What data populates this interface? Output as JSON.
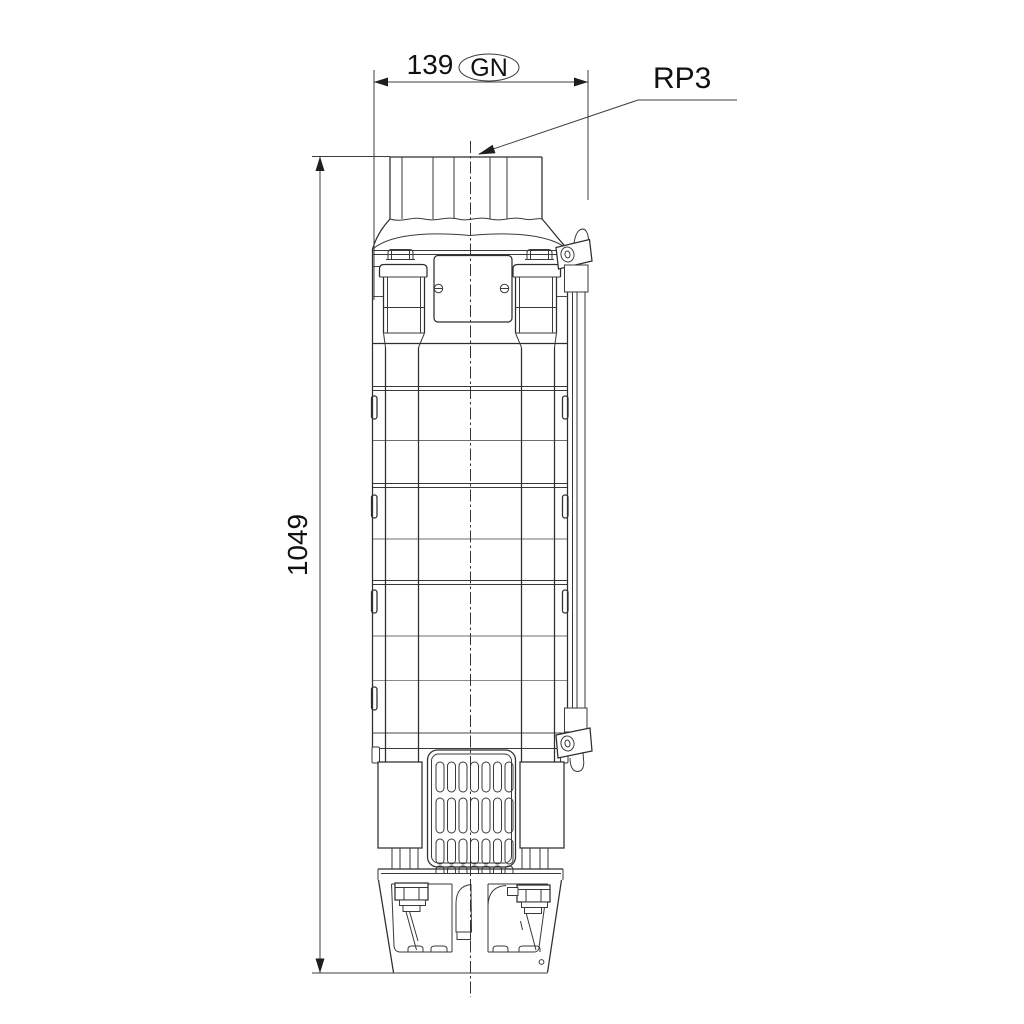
{
  "drawing": {
    "background_color": "#ffffff",
    "line_color": "#2e2e2e",
    "annotations": {
      "width_dimension": {
        "value": "139",
        "port_code": "GN"
      },
      "height_dimension": {
        "value": "1049"
      },
      "connection_label": {
        "value": "RP3"
      }
    }
  }
}
